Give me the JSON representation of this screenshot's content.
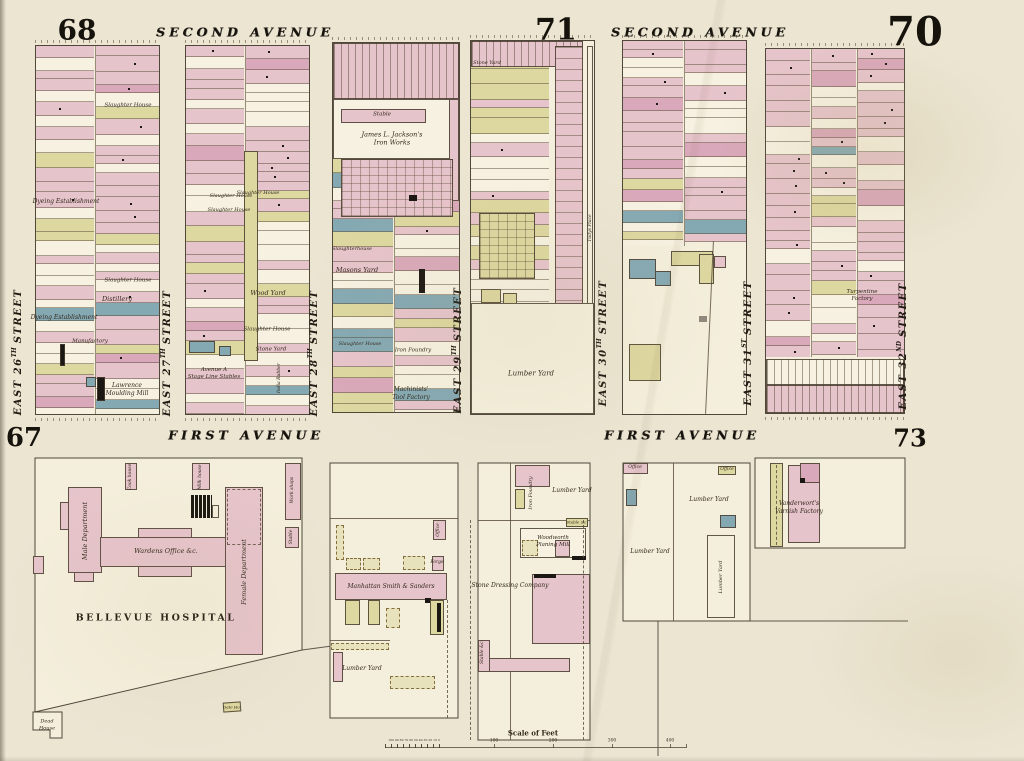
{
  "palette": {
    "paper": "#ebe5d2",
    "block": "#f4efdc",
    "lot_white": "#f6f1e1",
    "pink": "#e6c4cb",
    "rose": "#d9a8ba",
    "buff": "#ddd7a0",
    "blue": "#85a9b3",
    "gray": "#8f887a",
    "black": "#1b1712",
    "line": "#5d5140",
    "ink": "#2d2517"
  },
  "plates": {
    "top_left": "68",
    "top_center": "71",
    "top_right": "70",
    "bottom_left": "67",
    "bottom_right": "73"
  },
  "avenues": {
    "second": "SECOND AVENUE",
    "first": "FIRST AVENUE"
  },
  "streets": [
    {
      "pre": "EAST 26",
      "sup": "TH",
      "post": "STREET"
    },
    {
      "pre": "EAST 27",
      "sup": "TH",
      "post": "STREET"
    },
    {
      "pre": "EAST 28",
      "sup": "TH",
      "post": "STREET"
    },
    {
      "pre": "EAST 29",
      "sup": "TH",
      "post": "STREET"
    },
    {
      "pre": "EAST 30",
      "sup": "TH",
      "post": "STREET"
    },
    {
      "pre": "EAST 31",
      "sup": "ST",
      "post": "STREET"
    },
    {
      "pre": "EAST 32",
      "sup": "ND",
      "post": "STREET"
    }
  ],
  "labels": {
    "slaughter_house": "Slaughter House",
    "slaughterhouse": "Slaughterhouse",
    "distillery": "Distillery",
    "dyeing": "Dyeing Establishment",
    "manufactory": "Manufactory",
    "lawrence": "Lawrence\nMoulding Mill",
    "wood_yard": "Wood Yard",
    "avenue_a": "Avenue A\nStage Line Stables",
    "india_rubber": "India Rubber",
    "stone_yard": "Stone Yard",
    "stable": "Stable",
    "jackson": "James L. Jackson's\nIron Works",
    "masons": "Masons Yard",
    "iron_foundry": "Iron Foundry",
    "machinists": "Machinists'\nTool Factory",
    "lumber_yard": "Lumber Yard",
    "place": "Tudys Place",
    "turpentine": "Turpentine\nFactory",
    "male": "Male Department",
    "wardens": "Wardens Office &c.",
    "female": "Female Department",
    "bellevue": "BELLEVUE HOSPITAL",
    "cook": "Cook house",
    "milk": "Milk house",
    "workshops": "Work shops",
    "dead": "Dead\nHouse",
    "gate": "Gate Ho.",
    "manhattan": "Manhattan Smith & Sanders",
    "office": "Office",
    "forge": "Forge",
    "stable_c": "Stable &c.",
    "woodworth": "Woodworth\nPlaning Mill",
    "stone_dressing": "Stone Dressing Company",
    "varnish": "Vanderwort's\nVarnish Factory"
  },
  "scale": {
    "caption": "Scale of Feet",
    "minor": "100 90 80 70 60 50 40 30 20 10 0",
    "major": [
      "100",
      "200",
      "300",
      "400"
    ]
  }
}
